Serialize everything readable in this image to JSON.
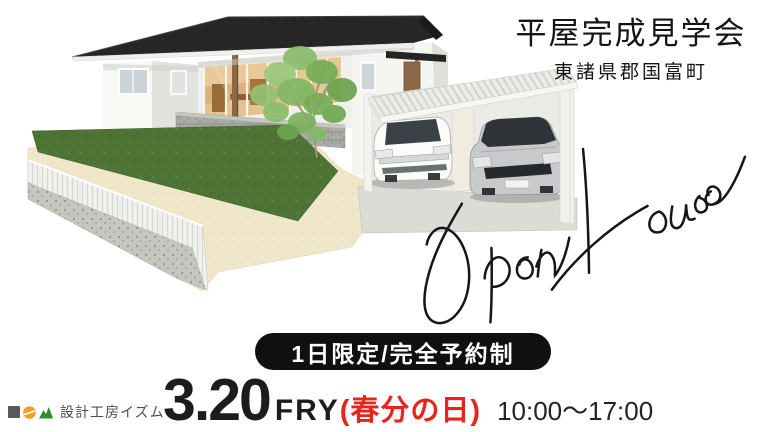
{
  "header": {
    "title": "平屋完成見学会",
    "location": "東諸県郡国富町"
  },
  "script": {
    "text": "Open House"
  },
  "badge": {
    "label": "1日限定/完全予約制"
  },
  "schedule": {
    "date": "3.20",
    "weekday": "FRY",
    "holiday": "(春分の日)",
    "time": "10:00～17:00"
  },
  "brand": {
    "name": "設計工房イズム"
  },
  "colors": {
    "text_black": "#1a1a1a",
    "accent_red": "#e7251b",
    "badge_bg": "#101010",
    "logo_square": "#5b5856",
    "logo_circle": "#f0a21e",
    "logo_mountain": "#2f8c35",
    "roof": "#262626",
    "wall_white": "#f7f7f4",
    "lawn_green": "#4d7435",
    "ground_beige": "#f0e7ca",
    "carport_roof": "#ebebe7"
  }
}
